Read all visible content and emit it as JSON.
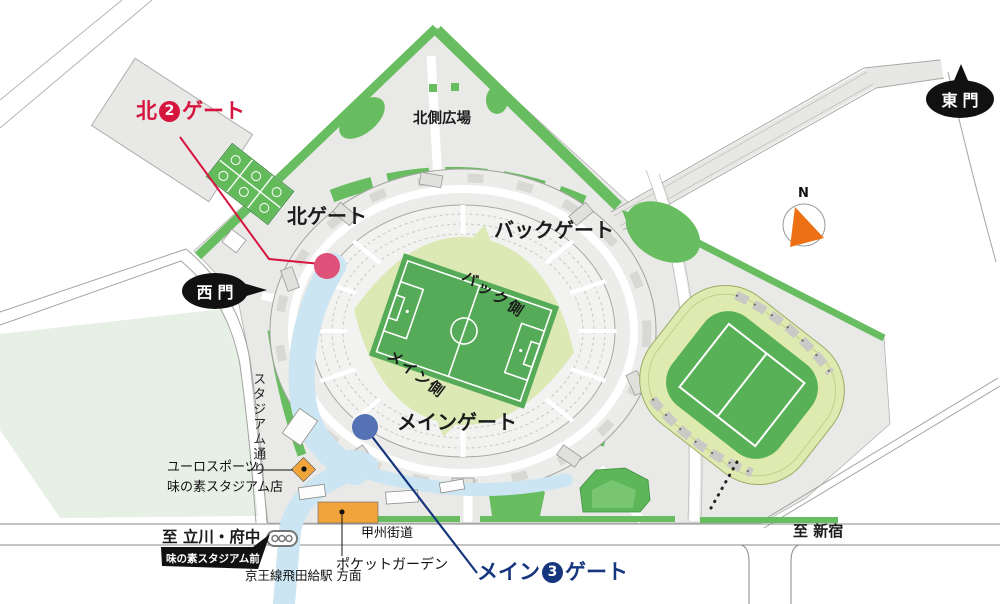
{
  "labels": {
    "north2_gate": {
      "prefix": "北",
      "number": "2",
      "suffix": "ゲート"
    },
    "main3_gate": {
      "prefix": "メイン",
      "number": "3",
      "suffix": "ゲート"
    },
    "north_gate": "北ゲート",
    "back_gate": "バックゲート",
    "main_gate": "メインゲート",
    "north_plaza": "北側広場",
    "back_side": "バック側",
    "main_side": "メイン側",
    "west_gate": "西門",
    "east_gate": "東門",
    "stadium_street": "スタジアム通り",
    "euro_sports_line1": "ユーロスポーツ",
    "euro_sports_line2": "味の素スタジアム店",
    "to_tachikawa": "至 立川・府中",
    "bus_stop": "味の素スタジアム前",
    "station_direction": "京王線飛田給駅 方面",
    "koshu_kaido": "甲州街道",
    "pocket_garden": "ポケットガーデン",
    "to_shinjuku": "至 新宿",
    "compass_north": "N"
  },
  "colors": {
    "accent_red": "#d6153f",
    "accent_blue": "#16357f",
    "north_gate_marker": "#e0517a",
    "main_gate_marker": "#5572b5",
    "green": "#68bd60",
    "mound_green": "#5db658",
    "park_green": "#e7f0e5",
    "surround_green": "#dde9b4",
    "pitch_green": "#55ab57",
    "track_ring_green": "#dfeab0",
    "infield_green": "#58b156",
    "walkway_blue": "#cbe5f3",
    "orange": "#f2a43c",
    "compass_orange": "#ed7114",
    "site_gray": "#e9e9e7"
  }
}
